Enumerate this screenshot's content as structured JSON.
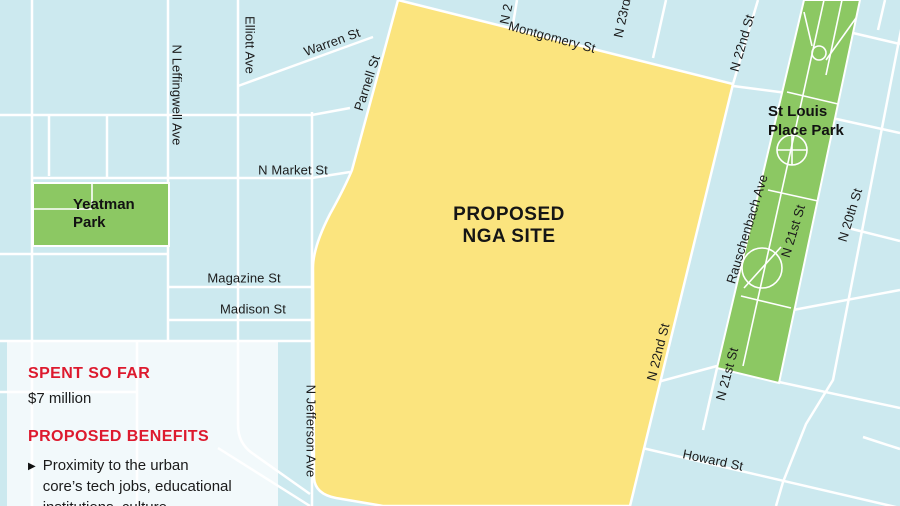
{
  "colors": {
    "map-background": "#cce9ef",
    "site-fill": "#fbe47e",
    "park-fill": "#8cc863",
    "street-line": "#ffffff",
    "panel-background": "rgba(255,255,255,0.74)",
    "accent-red": "#dd1a2e",
    "text-black": "#1b1b1b"
  },
  "map": {
    "site": {
      "lines": [
        "PROPOSED",
        "NGA SITE"
      ]
    },
    "yeatman_park": {
      "lines": [
        "Yeatman",
        "Park"
      ]
    },
    "stlouis_park": {
      "lines": [
        "St Louis",
        "Place Park"
      ]
    },
    "streets": {
      "warren": "Warren St",
      "parnell": "Parnell St",
      "leffingwell": "N Leffingwell Ave",
      "elliott": "Elliott Ave",
      "market": "N Market St",
      "magazine": "Magazine St",
      "madison": "Madison St",
      "jefferson": "N Jefferson Ave",
      "montgomery": "Montgomery St",
      "n2": "N 2",
      "n23rd": "N 23rd",
      "n22nd_upper": "N 22nd St",
      "n22nd_lower": "N 22nd St",
      "rauschenbach": "Rauschenbach Ave",
      "n21st_upper": "N 21st St",
      "n21st_lower": "N 21st St",
      "n20th": "N 20th St",
      "howard": "Howard St"
    }
  },
  "panel": {
    "spent_heading": "SPENT SO FAR",
    "spent_value": "$7 million",
    "benefits_heading": "PROPOSED BENEFITS",
    "bullet_icon": "▶",
    "benefit_lines": [
      "Proximity to the urban",
      "core’s tech jobs, educational",
      "institutions, culture"
    ]
  }
}
